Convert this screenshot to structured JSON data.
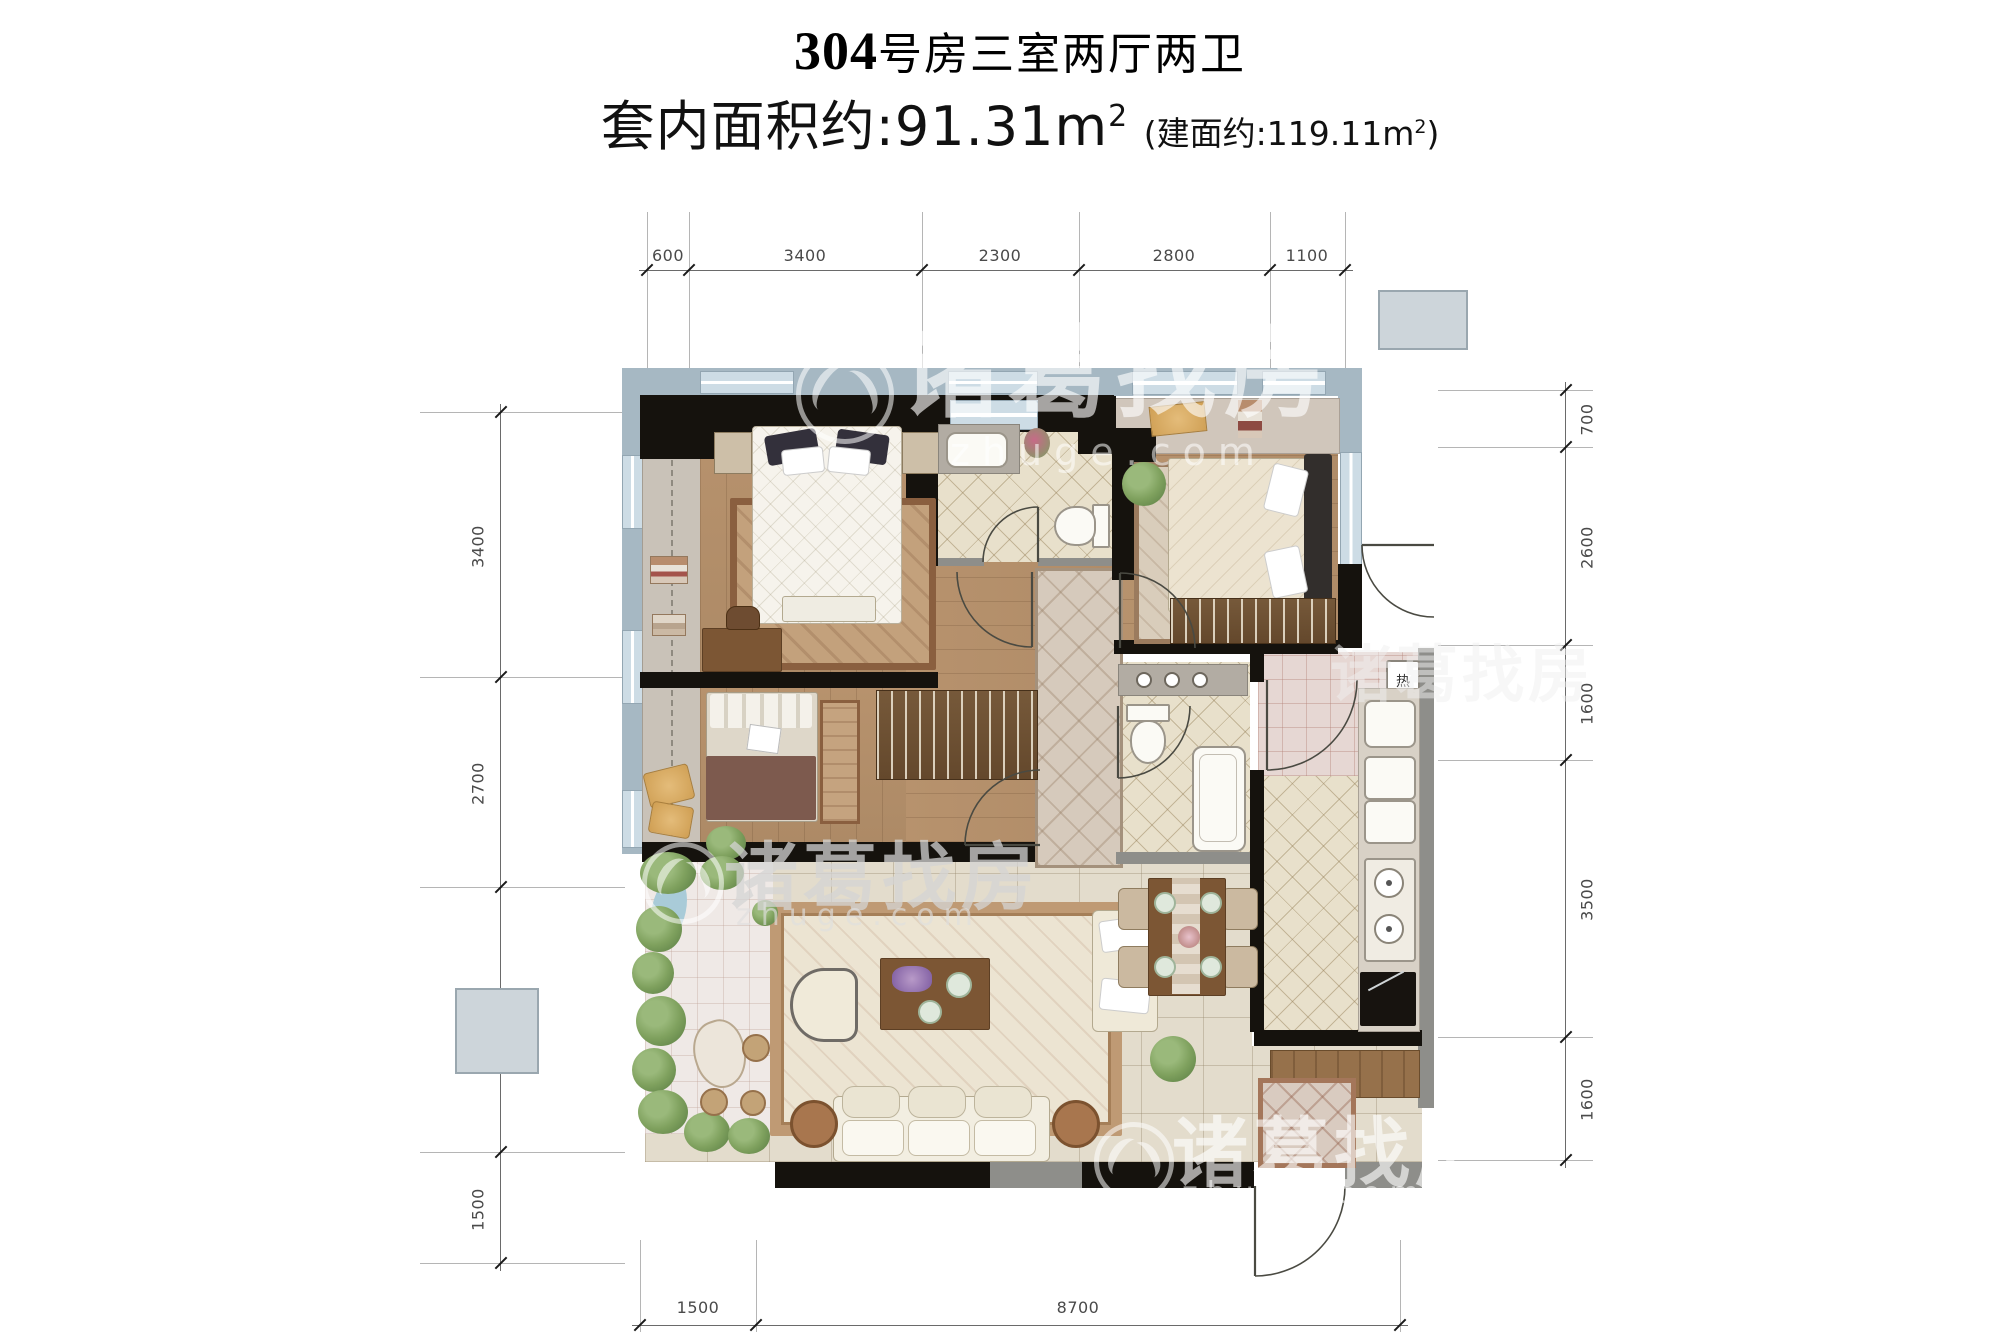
{
  "header": {
    "room_number": "304",
    "title_suffix": "号房三室两厅两卫",
    "area_prefix": "套内面积约:",
    "area_value": "91.31",
    "area_unit": "m",
    "area_superscript": "2",
    "built_prefix": "(建面约:",
    "built_value": "119.11",
    "built_unit": "m",
    "built_superscript": "2",
    "built_suffix": ")"
  },
  "dimensions": {
    "top": [
      "600",
      "3400",
      "2300",
      "2800",
      "1100"
    ],
    "left": [
      "3400",
      "2700",
      "3900",
      "1500"
    ],
    "right": [
      "700",
      "2600",
      "1600",
      "3500",
      "1600"
    ],
    "bottom": [
      "1500",
      "8700"
    ]
  },
  "watermark": {
    "brand": "诸葛找房",
    "domain": "zhuge.com"
  },
  "labels": {
    "water_heater": "热"
  },
  "colors": {
    "wall": "#15120d",
    "window_band": "#a6b8c3",
    "wood_floor": "#b3906c",
    "bath_tile": "#e8e0cb",
    "living_tile": "#e3dccc",
    "garden_green": "#6f9357",
    "runner": "#d3c8ba",
    "accent_wood": "#7c5634"
  }
}
